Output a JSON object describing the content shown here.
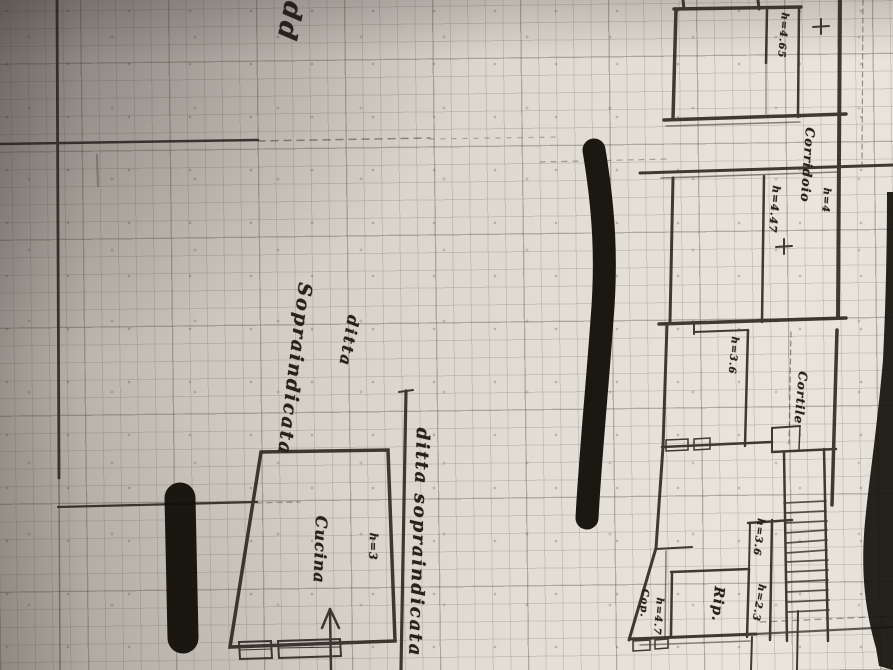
{
  "annotations": {
    "handwritten_note": "odd",
    "owner_word_1": "ditta",
    "owner_word_2": "Sopraindicata",
    "boundary_note": "ditta sopraindicata"
  },
  "rooms": {
    "cucina_name": "Cucina",
    "cucina_height": "h=3",
    "corridoio_name": "Corridoio",
    "corridoio_height": "h=4",
    "cortile_name": "Cortile",
    "rip_name": "Rip.",
    "cop_name": "Cop.",
    "cop_height": "h=4.7",
    "upper_room_height": "h=4.65",
    "mid_room_height": "h=4.47",
    "lower_room_height": "h=3.6",
    "small_room_a_height": "h=3.6",
    "small_room_b_height": "h=2.3"
  },
  "colors": {
    "ink": "#2b2620",
    "redaction_ink": "#131009",
    "paper_light": "#e9e5dc",
    "paper_dark": "#9e9992"
  }
}
